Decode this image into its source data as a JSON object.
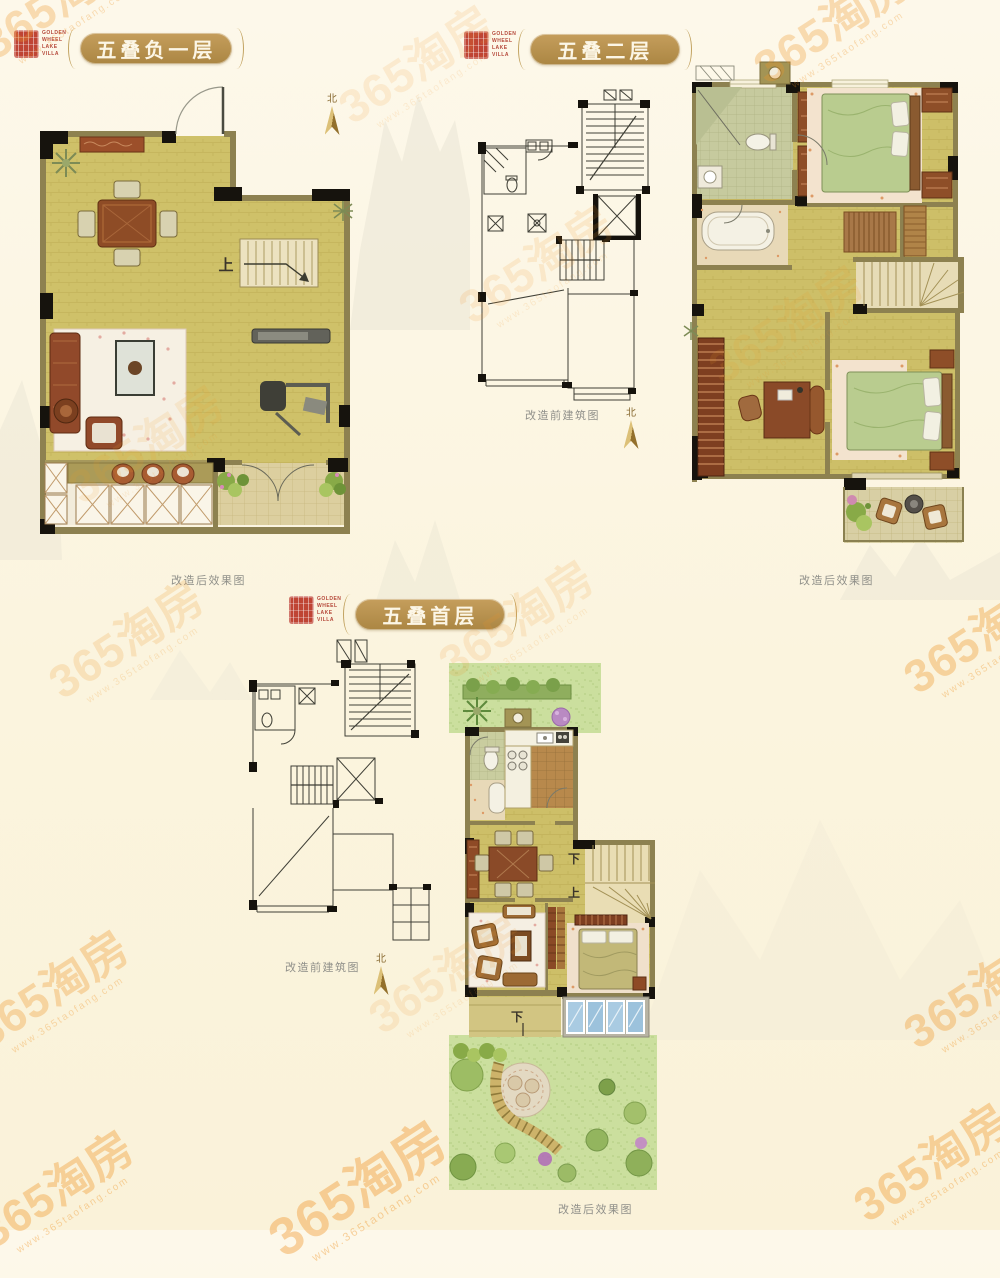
{
  "page": {
    "background": "#fbf4de"
  },
  "brand_seal": {
    "lines": [
      "GOLDEN",
      "WHEEL",
      "LAKE",
      "VILLA"
    ],
    "stamp_color": "#bf4434",
    "text_color": "#b5483a"
  },
  "watermark": {
    "brand": "365淘房",
    "url": "www.365taofang.com",
    "color": "#ef9426",
    "items": [
      {
        "x": 62,
        "y": 6,
        "o": 0.3
      },
      {
        "x": 420,
        "y": 70,
        "o": 0.14
      },
      {
        "x": 835,
        "y": 30,
        "o": 0.3
      },
      {
        "x": 540,
        "y": 270,
        "o": 0.15
      },
      {
        "x": 790,
        "y": 330,
        "o": 0.13
      },
      {
        "x": 150,
        "y": 450,
        "o": 0.13
      },
      {
        "x": 130,
        "y": 645,
        "o": 0.2
      },
      {
        "x": 520,
        "y": 625,
        "o": 0.15
      },
      {
        "x": 985,
        "y": 640,
        "o": 0.36
      },
      {
        "x": 55,
        "y": 995,
        "o": 0.33
      },
      {
        "x": 450,
        "y": 980,
        "o": 0.14
      },
      {
        "x": 985,
        "y": 995,
        "o": 0.36
      },
      {
        "x": 60,
        "y": 1195,
        "o": 0.38
      },
      {
        "x": 362,
        "y": 1195,
        "o": 0.4,
        "s": 1.15
      },
      {
        "x": 935,
        "y": 1168,
        "o": 0.38
      }
    ]
  },
  "sections": {
    "basement": {
      "title": "五叠负一层",
      "caption_after": "改造后效果图",
      "north_label": "北",
      "stair_up_label": "上"
    },
    "second": {
      "title": "五叠二层",
      "caption_before": "改造前建筑图",
      "caption_after": "改造后效果图",
      "north_label": "北"
    },
    "first": {
      "title": "五叠首层",
      "caption_before": "改造前建筑图",
      "caption_after": "改造后效果图",
      "north_label": "北",
      "stair_down_label": "下",
      "stair_up_label": "上",
      "step_down_label": "下"
    }
  },
  "colors": {
    "title_gold": "#b2904c",
    "seal_red": "#bf4434",
    "watermark_orange": "#ef9426",
    "caption_gray": "#90908a",
    "floor_tan": "#cfc169",
    "wall_olive": "#8d8150",
    "garden_green": "#c8dc9a",
    "north_gold": "#b5913c",
    "bed_green": "#b9cc8f",
    "glass_blue": "#a9cbe2"
  }
}
